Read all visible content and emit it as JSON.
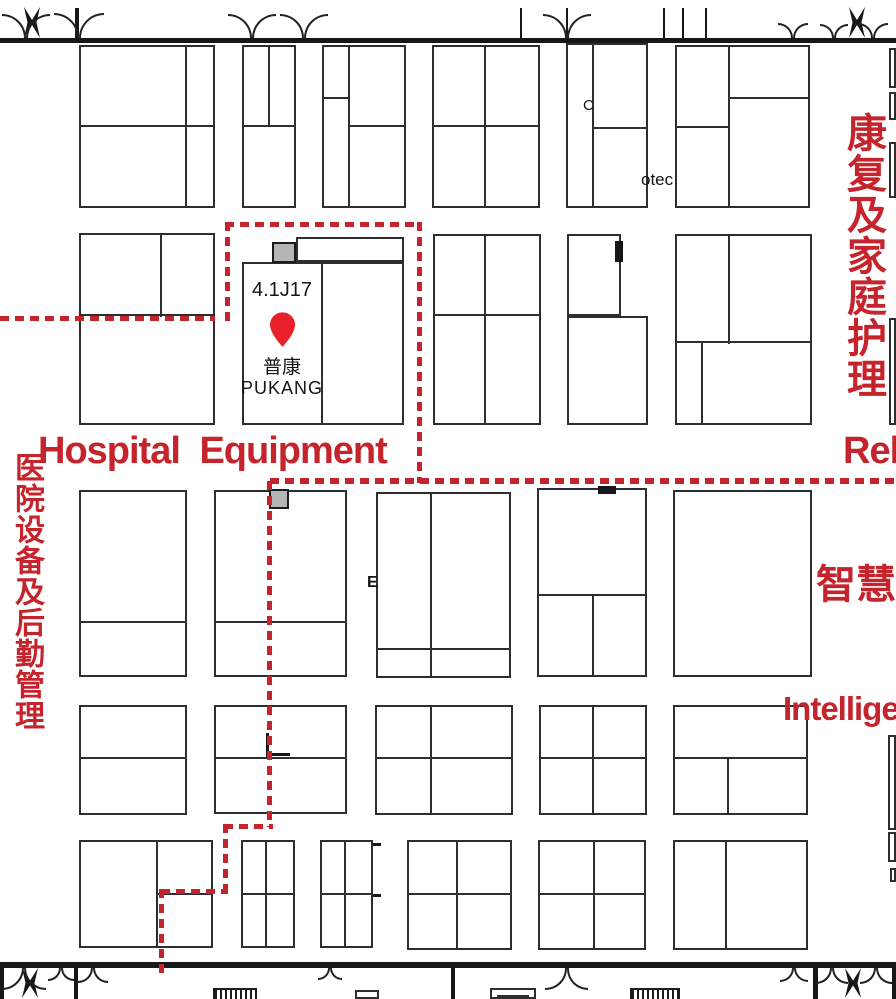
{
  "zones": {
    "hospital_equipment": "Hospital Equipment",
    "rehabilitation_partial": "Reh",
    "smart_health_partial": "智慧健",
    "intelligent_partial": "Intellige",
    "hospital_logistics_vertical": "医院设备及后勤管理",
    "rehab_home_care_vertical": "康复及家庭护理"
  },
  "booth": {
    "id": "4.1J17",
    "name_cn": "普康",
    "name_en": "PUKANG"
  },
  "small_texts": {
    "otec": "otec",
    "e_mark": "E",
    "c_mark": "C"
  },
  "colors": {
    "zone_red": "#c5242c",
    "pin_red": "#e8202a",
    "line_dark": "#2e2e2e",
    "gray_fill": "#b5b5b5"
  },
  "map": {
    "walls": [
      [
        0,
        38,
        896,
        5
      ],
      [
        0,
        962,
        896,
        6
      ]
    ],
    "booths": [
      [
        79,
        45,
        136,
        163
      ],
      [
        242,
        45,
        54,
        163
      ],
      [
        322,
        45,
        84,
        163
      ],
      [
        432,
        45,
        108,
        163
      ],
      [
        566,
        43,
        82,
        165
      ],
      [
        675,
        45,
        135,
        163
      ],
      [
        889,
        48,
        7,
        40
      ],
      [
        889,
        92,
        7,
        28
      ],
      [
        889,
        142,
        7,
        56
      ],
      [
        79,
        233,
        136,
        192
      ],
      [
        296,
        237,
        108,
        25
      ],
      [
        242,
        262,
        162,
        163
      ],
      [
        433,
        234,
        108,
        191
      ],
      [
        567,
        234,
        54,
        82
      ],
      [
        567,
        316,
        81,
        109
      ],
      [
        675,
        234,
        137,
        191
      ],
      [
        889,
        318,
        7,
        107
      ],
      [
        79,
        490,
        108,
        187
      ],
      [
        214,
        490,
        133,
        187
      ],
      [
        376,
        492,
        135,
        186
      ],
      [
        537,
        488,
        110,
        189
      ],
      [
        673,
        490,
        139,
        187
      ],
      [
        79,
        705,
        108,
        110
      ],
      [
        214,
        705,
        133,
        109
      ],
      [
        375,
        705,
        138,
        110
      ],
      [
        539,
        705,
        108,
        110
      ],
      [
        673,
        705,
        135,
        110
      ],
      [
        888,
        735,
        8,
        95
      ],
      [
        79,
        840,
        134,
        108
      ],
      [
        241,
        840,
        54,
        108
      ],
      [
        320,
        840,
        53,
        108
      ],
      [
        407,
        840,
        105,
        110
      ],
      [
        538,
        840,
        108,
        110
      ],
      [
        673,
        840,
        135,
        110
      ],
      [
        888,
        832,
        8,
        30
      ],
      [
        890,
        868,
        6,
        14
      ]
    ],
    "dividers": [
      [
        79,
        125,
        136,
        2
      ],
      [
        185,
        45,
        2,
        163
      ],
      [
        268,
        45,
        2,
        82
      ],
      [
        242,
        125,
        54,
        2
      ],
      [
        348,
        45,
        2,
        163
      ],
      [
        322,
        97,
        27,
        2
      ],
      [
        349,
        125,
        57,
        2
      ],
      [
        484,
        45,
        2,
        163
      ],
      [
        432,
        125,
        108,
        2
      ],
      [
        592,
        43,
        2,
        165
      ],
      [
        593,
        127,
        55,
        2
      ],
      [
        728,
        45,
        2,
        163
      ],
      [
        675,
        126,
        54,
        2
      ],
      [
        730,
        97,
        80,
        2
      ],
      [
        160,
        233,
        2,
        84
      ],
      [
        79,
        314,
        136,
        2
      ],
      [
        321,
        262,
        2,
        163
      ],
      [
        484,
        234,
        2,
        191
      ],
      [
        433,
        314,
        108,
        2
      ],
      [
        728,
        234,
        2,
        110
      ],
      [
        675,
        341,
        137,
        2
      ],
      [
        701,
        343,
        2,
        82
      ],
      [
        79,
        621,
        108,
        2
      ],
      [
        214,
        621,
        133,
        2
      ],
      [
        430,
        492,
        2,
        186
      ],
      [
        376,
        648,
        135,
        2
      ],
      [
        537,
        594,
        110,
        2
      ],
      [
        592,
        596,
        2,
        81
      ],
      [
        79,
        757,
        108,
        2
      ],
      [
        214,
        757,
        133,
        2
      ],
      [
        430,
        705,
        2,
        110
      ],
      [
        375,
        757,
        138,
        2
      ],
      [
        592,
        705,
        2,
        110
      ],
      [
        539,
        757,
        108,
        2
      ],
      [
        673,
        757,
        135,
        2
      ],
      [
        727,
        759,
        2,
        56
      ],
      [
        156,
        840,
        2,
        108
      ],
      [
        157,
        893,
        56,
        2
      ],
      [
        265,
        840,
        2,
        108
      ],
      [
        241,
        893,
        54,
        2
      ],
      [
        344,
        840,
        2,
        108
      ],
      [
        320,
        893,
        53,
        2
      ],
      [
        456,
        840,
        2,
        110
      ],
      [
        407,
        893,
        105,
        2
      ],
      [
        593,
        840,
        2,
        110
      ],
      [
        538,
        893,
        108,
        2
      ],
      [
        725,
        840,
        2,
        110
      ]
    ],
    "symbols": [
      [
        490,
        988,
        46,
        11
      ],
      [
        497,
        995,
        32,
        4
      ],
      [
        355,
        990,
        24,
        9
      ]
    ],
    "posts": [
      [
        75,
        8,
        4,
        30
      ],
      [
        0,
        962,
        4,
        37
      ],
      [
        74,
        968,
        4,
        31
      ],
      [
        451,
        968,
        4,
        31
      ],
      [
        813,
        968,
        5,
        31
      ],
      [
        892,
        968,
        4,
        31
      ]
    ],
    "xposts": [
      [
        24,
        7,
        16,
        31
      ],
      [
        849,
        7,
        16,
        31
      ],
      [
        22,
        968,
        16,
        30
      ],
      [
        845,
        968,
        16,
        30
      ]
    ],
    "jambs": [
      [
        520,
        8,
        2,
        30
      ],
      [
        566,
        8,
        2,
        30
      ],
      [
        663,
        8,
        2,
        30
      ],
      [
        682,
        8,
        2,
        30
      ],
      [
        705,
        8,
        2,
        30
      ]
    ],
    "arc_pairs_top": [
      [
        2,
        50
      ],
      [
        54,
        104
      ],
      [
        228,
        276
      ],
      [
        280,
        328
      ],
      [
        543,
        591
      ],
      [
        778,
        808
      ],
      [
        820,
        848
      ],
      [
        858,
        888
      ]
    ],
    "arc_pairs_bottom": [
      [
        2,
        46
      ],
      [
        48,
        74
      ],
      [
        78,
        108
      ],
      [
        318,
        342
      ],
      [
        545,
        588
      ],
      [
        780,
        808
      ],
      [
        816,
        848
      ],
      [
        860,
        892
      ]
    ],
    "gray_squares": [
      [
        272,
        242,
        24,
        21
      ],
      [
        269,
        489,
        20,
        20
      ]
    ],
    "black_marks": [
      [
        615,
        241,
        8,
        21
      ],
      [
        598,
        486,
        18,
        8
      ],
      [
        266,
        733,
        3,
        24
      ],
      [
        266,
        753,
        24,
        3
      ],
      [
        373,
        843,
        8,
        3
      ],
      [
        373,
        894,
        8,
        3
      ]
    ],
    "hatches": [
      [
        213,
        988,
        44,
        11
      ],
      [
        630,
        988,
        50,
        11
      ]
    ],
    "dashes_h": [
      [
        0,
        316,
        215,
        5
      ],
      [
        225,
        222,
        197,
        5
      ],
      [
        270,
        478,
        626,
        6
      ],
      [
        224,
        824,
        49,
        5
      ],
      [
        161,
        889,
        67,
        5
      ]
    ],
    "dashes_v": [
      [
        225,
        222,
        5,
        99
      ],
      [
        417,
        222,
        5,
        261
      ],
      [
        267,
        481,
        5,
        346
      ],
      [
        223,
        824,
        5,
        70
      ],
      [
        159,
        889,
        5,
        85
      ]
    ]
  }
}
